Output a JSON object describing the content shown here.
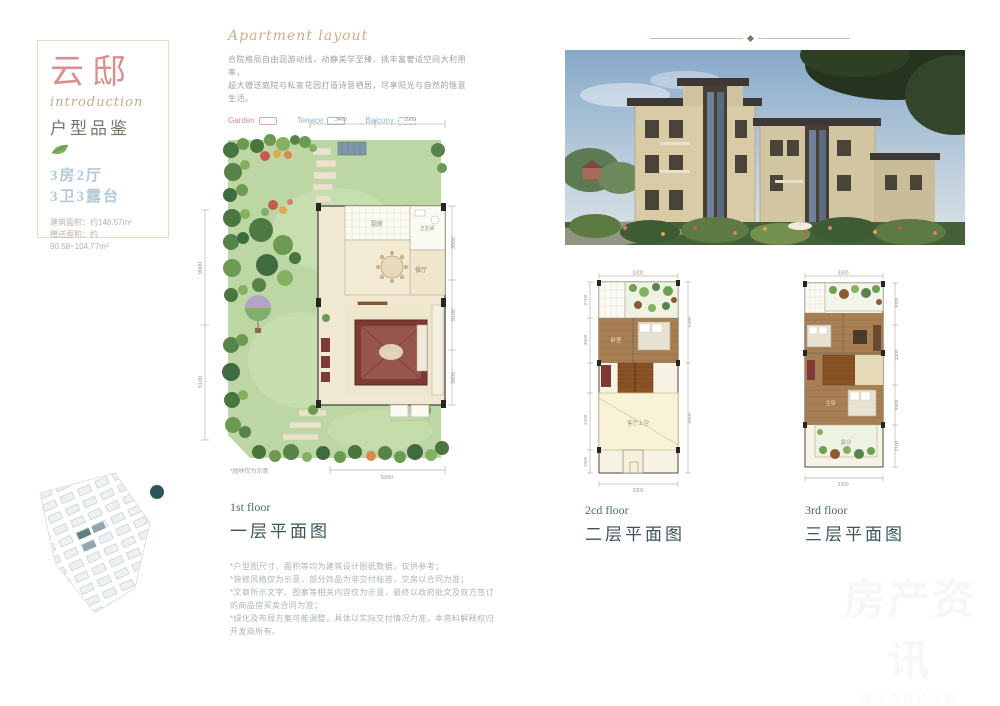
{
  "colors": {
    "title_pink": "#d98f8f",
    "script_tan": "#c9b088",
    "floor_label_teal": "#39565a",
    "rooms_blue": "#b3cad6",
    "lawn_green": "#bdd7a4",
    "wood_floor": "#a87f54",
    "rug_red": "#7c3a33",
    "legend_red": "#d98f8f",
    "legend_blue": "#8fb7cc"
  },
  "info_card": {
    "title": "云邸",
    "script": "introduction",
    "subtitle": "户型品鉴",
    "rooms_line1": "3房2厅",
    "rooms_line2": "3卫3露台",
    "area_line1": "建筑面积：约148.57m²",
    "area_line2": "赠送面积：约90.58~104.77m²"
  },
  "intro": {
    "script_title": "Apartment layout",
    "desc_line1": "合院格局自由洄游动线，动静美学至臻，挑丰富奢适空间大利用率，",
    "desc_line2": "超大赠送庭院与私家花园打造诗意栖居，尽享阳光与自然的惬意生活。",
    "legend": [
      {
        "label": "Garden",
        "color": "#d98f8f",
        "box": "solid"
      },
      {
        "label": "Terrace",
        "color": "#8fb7cc",
        "box": "solid"
      },
      {
        "label": "Balcony",
        "color": "#8fb7cc",
        "box": "dashed"
      }
    ]
  },
  "plans": {
    "first": {
      "label_en": "1st floor",
      "label_cn": "一层平面图",
      "note": "*园林仅为示意",
      "rooms": {
        "kitchen": "厨房",
        "dining": "餐厅",
        "living": "客厅",
        "bath": "卫生间"
      },
      "dims": {
        "top1": "3400",
        "top2": "5900",
        "left1": "9000",
        "left2": "5100",
        "right1": "3900",
        "right2": "5100",
        "right3": "3600",
        "bottom": "5900"
      }
    },
    "second": {
      "label_en": "2cd floor",
      "label_cn": "二层平面图",
      "void_label": "客厅上空",
      "rooms": {
        "bed": "卧室"
      },
      "dims": {
        "top": "3300",
        "left1": "2700",
        "left2": "3600",
        "left3": "4200",
        "left4": "1800",
        "right1": "5400",
        "right2": "6900",
        "bottom": "3300"
      }
    },
    "third": {
      "label_en": "3rd floor",
      "label_cn": "三层平面图",
      "rooms": {
        "master": "主卧",
        "bed": "卧室",
        "terrace": "露台"
      },
      "dims": {
        "top": "3300",
        "right1": "3000",
        "right2": "3300",
        "right3": "3900",
        "right4": "2100",
        "bottom": "3300"
      }
    }
  },
  "disclaimers": [
    "*户型图尺寸、面积等均为建筑设计图纸数据，仅供参考；",
    "*装修风格仅为示意，部分饰品为非交付标准，交房以合同为准；",
    "*文章所示文字、图案等相关内容仅为示意，最终以政府批文及双方签订的商品房买卖合同为准；",
    "*绿化及布局方案可能调整，具体以实际交付情况为准，本资料解释权归开发商所有。"
  ],
  "watermark": {
    "line1": "房产资讯",
    "line2": "楼市资讯抢先看"
  }
}
